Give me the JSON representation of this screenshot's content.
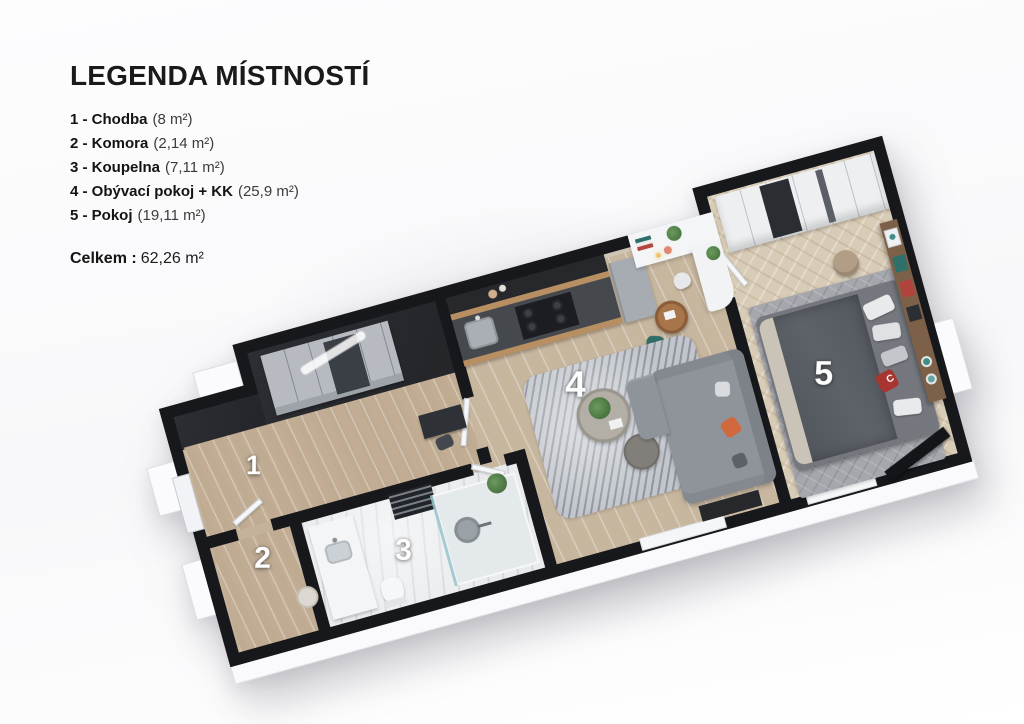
{
  "legend": {
    "title": "LEGENDA MÍSTNOSTÍ",
    "rooms": [
      {
        "num": "1",
        "label": "1 - Chodba",
        "area": "(8 m²)"
      },
      {
        "num": "2",
        "label": "2 - Komora",
        "area": "(2,14 m²)"
      },
      {
        "num": "3",
        "label": "3 - Koupelna",
        "area": "(7,11 m²)"
      },
      {
        "num": "4",
        "label": "4 - Obývací pokoj + KK",
        "area": "(25,9 m²)"
      },
      {
        "num": "5",
        "label": "5 - Pokoj",
        "area": "(19,11 m²)"
      }
    ],
    "total_label": "Celkem :",
    "total_value": "62,26 m²"
  },
  "floorplan": {
    "pillow_letter": "C",
    "colors": {
      "wall": "#17181c",
      "wood_floor": "#c7b49c",
      "living_wood_floor": "#cdbda6",
      "herringbone_floor": "#d9ccb6",
      "marble_floor": "#e9ebed",
      "carpet": "#a6a7ad",
      "bed_duvet": "#565a60",
      "sofa": "#8f939a",
      "accent_orange": "#d2683e",
      "chair_teal": "#2f6e68",
      "kitchen_cabinet_wood": "#b78f63",
      "countertop": "#45494e",
      "fridge": "#a6acb2"
    }
  }
}
